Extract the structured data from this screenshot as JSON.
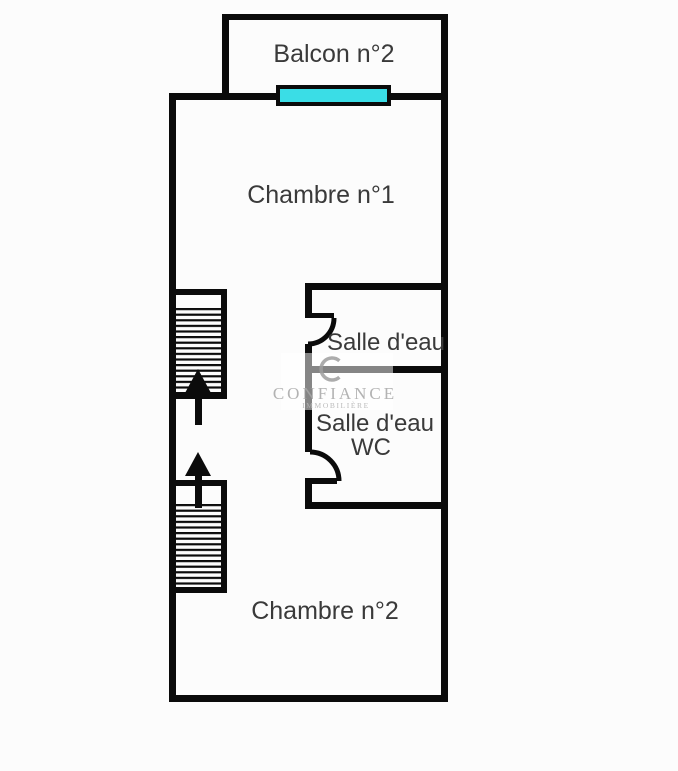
{
  "document_type": "floor-plan",
  "rooms": {
    "balcony": {
      "label": "Balcon n°2"
    },
    "bedroom_1": {
      "label": "Chambre n°1"
    },
    "shower_room": {
      "label": "Salle d'eau"
    },
    "shower_room_wc": {
      "label_line_1": "Salle d'eau",
      "label_line_2": "WC"
    },
    "bedroom_2": {
      "label": "Chambre n°2"
    }
  },
  "watermark": {
    "name": "CONFIANCE",
    "subtitle": "IMMOBILIÈRE"
  },
  "features": {
    "window": "cyan-window-segment-on-top-wall",
    "staircase_upper": "hatched-staircase-with-up-arrow",
    "staircase_lower": "hatched-staircase-with-up-arrow",
    "door_upper": "quarter-circle-door-swing",
    "door_lower": "quarter-circle-door-swing"
  },
  "colors": {
    "wall": "#0b0b0b",
    "window_fill": "#3adde6",
    "label_text": "#3a3a3a",
    "watermark_gray": "#a6a6a6",
    "watermark_sub_gray": "#b4b4b4",
    "background": "#fcfcfc"
  }
}
